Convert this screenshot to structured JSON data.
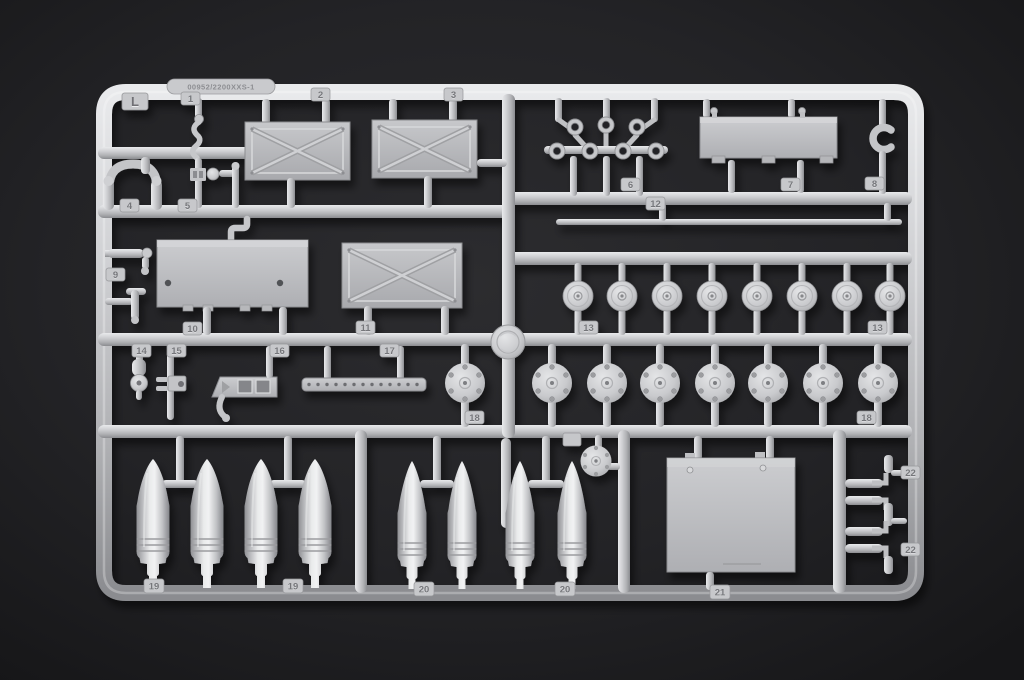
{
  "sprue": {
    "letter": "L",
    "mold_text": "00952/2200XXS-1",
    "tabs": [
      "1",
      "2",
      "3",
      "4",
      "5",
      "6",
      "7",
      "8",
      "9",
      "10",
      "11",
      "12",
      "13",
      "13",
      "14",
      "15",
      "16",
      "17",
      "18",
      "18",
      "19",
      "19",
      "20",
      "20",
      "21",
      "22",
      "22"
    ],
    "colors": {
      "plastic": "#c8c9cc",
      "plastic_highlight": "#e9eaec",
      "plastic_shadow": "#8b8c90",
      "background": "#1e1e21"
    }
  }
}
